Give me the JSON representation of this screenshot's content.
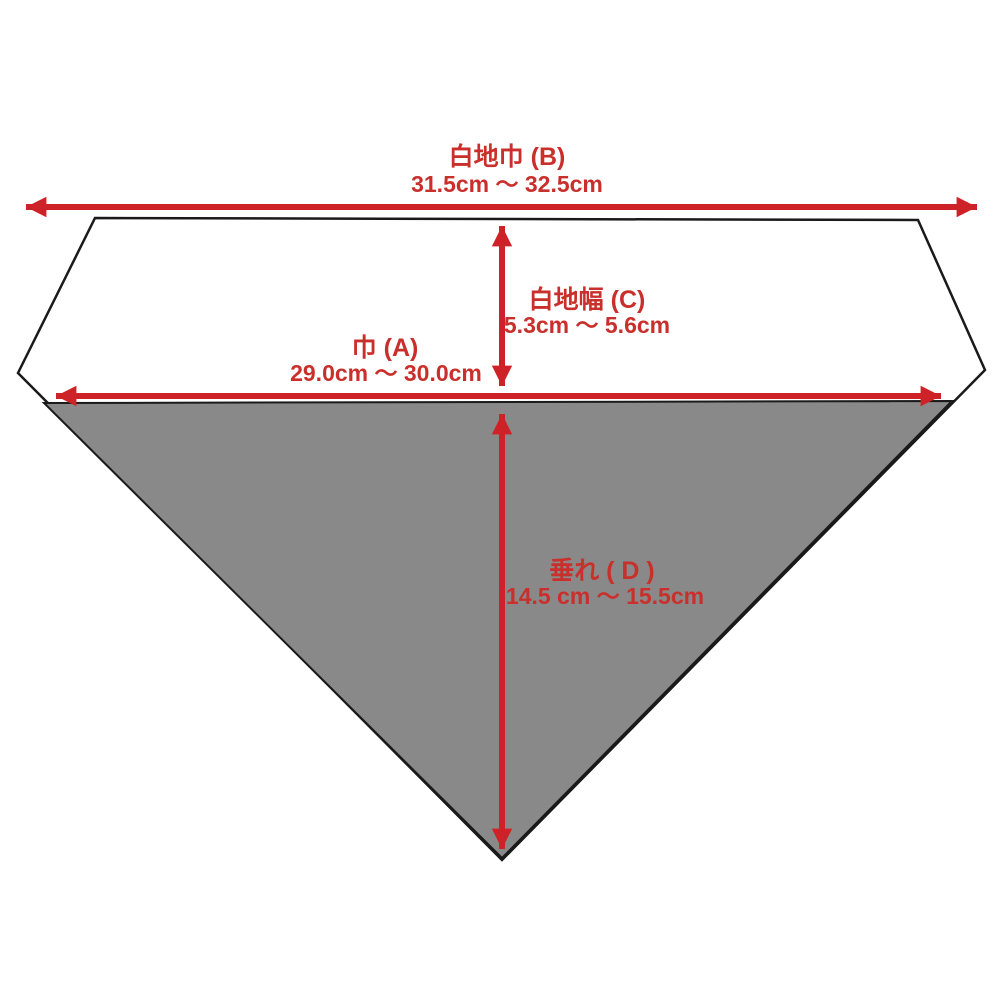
{
  "colors": {
    "background": "#ffffff",
    "arrow_red": "#cd2328",
    "label_red": "#c9302c",
    "fabric_gray": "#898989",
    "outline_black": "#1a1a1a"
  },
  "measurements": {
    "B": {
      "label": "白地巾 (B)",
      "range": "31.5cm ～ 32.5cm"
    },
    "C": {
      "label": "白地幅 (C)",
      "range": "5.3cm ～ 5.6cm"
    },
    "A": {
      "label": "巾 (A)",
      "range": "29.0cm ～ 30.0cm"
    },
    "D": {
      "label": "垂れ ( D )",
      "range": "14.5 cm ～ 15.5cm"
    }
  }
}
